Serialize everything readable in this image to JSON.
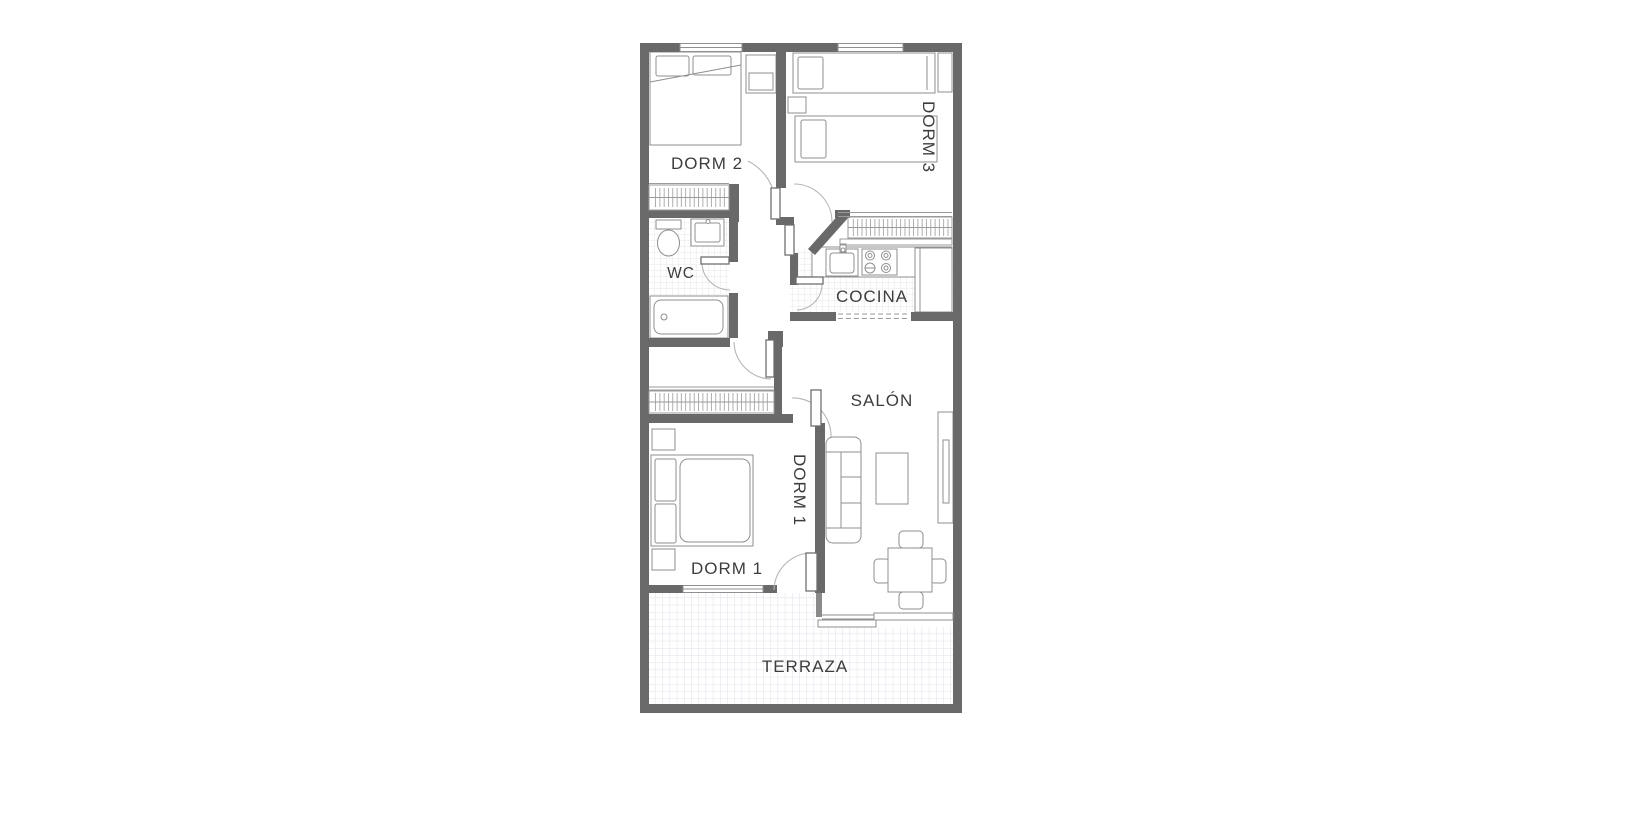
{
  "floorplan": {
    "type": "apartment-floor-plan",
    "palette": {
      "wall": "#696969",
      "furniture_outline": "#8f8f8f",
      "door_arc": "#b5b5b5",
      "tile_grid": "#e2e2ea",
      "label_text": "#3d3d3d",
      "background": "#ffffff"
    },
    "labels": {
      "dorm2": "DORM 2",
      "dorm3": "DORM 3",
      "wc": "WC",
      "cocina": "COCINA",
      "salon": "SALÓN",
      "dorm1_vertical": "DORM 1",
      "dorm1": "DORM 1",
      "terraza": "TERRAZA"
    }
  }
}
